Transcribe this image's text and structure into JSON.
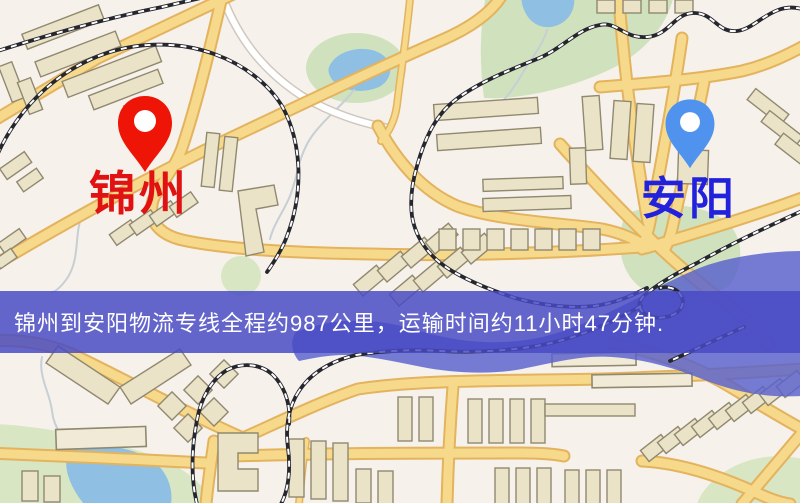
{
  "banner": {
    "text": "锦州到安阳物流专线全程约987公里，运输时间约11小时47分钟.",
    "bg_color": "rgba(72,74,197,0.84)",
    "text_color": "#ffffff"
  },
  "markers": {
    "origin": {
      "label": "锦州",
      "pin_color": "#ee1507",
      "label_color": "#e01212"
    },
    "destination": {
      "label": "安阳",
      "pin_color": "#4f93ee",
      "label_color": "#2222dd"
    }
  },
  "map_colors": {
    "background": "#f7f1ec",
    "park": "#cfe2bd",
    "water": "#8fbfe2",
    "river": "rgba(88,96,205,0.82)",
    "road_fill": "#f6d98b",
    "road_casing": "#e3b35e",
    "building_fill": "#ebe3c8",
    "building_stroke": "#90896f",
    "railway": "#26262e"
  }
}
